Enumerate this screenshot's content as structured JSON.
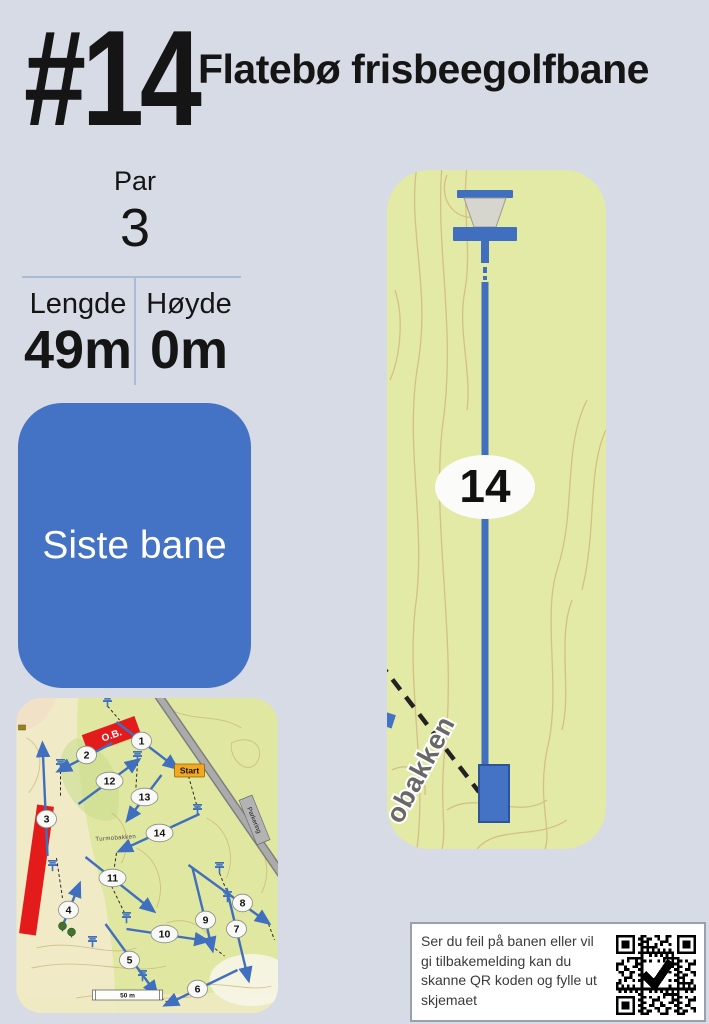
{
  "header": {
    "hole_number": "#14",
    "course_title": "Flatebø frisbeegolfbane"
  },
  "stats": {
    "par_label": "Par",
    "par_value": "3",
    "length_label": "Lengde",
    "length_value": "49m",
    "height_label": "Høyde",
    "height_value": "0m"
  },
  "status_card": {
    "label": "Siste bane",
    "color": "#4472c4"
  },
  "hole_map": {
    "hole_label": "14",
    "road_label": "obakken",
    "map_bg": "#e3eaa5",
    "line_color": "#3f6fbe",
    "contour_color": "#d2b97f"
  },
  "overview_map": {
    "map_bg": "#dfe7a0",
    "labels": {
      "start": "Start",
      "parking": "Parkering",
      "ob": "O.B.",
      "scale": "50 m",
      "road_small": "Turmobakken"
    },
    "hole_markers": [
      {
        "n": "1",
        "x": 125,
        "y": 43
      },
      {
        "n": "2",
        "x": 70,
        "y": 57
      },
      {
        "n": "3",
        "x": 30,
        "y": 121
      },
      {
        "n": "4",
        "x": 52,
        "y": 212
      },
      {
        "n": "5",
        "x": 113,
        "y": 262
      },
      {
        "n": "6",
        "x": 181,
        "y": 291
      },
      {
        "n": "7",
        "x": 220,
        "y": 231
      },
      {
        "n": "8",
        "x": 226,
        "y": 205
      },
      {
        "n": "9",
        "x": 189,
        "y": 222
      },
      {
        "n": "10",
        "x": 148,
        "y": 236
      },
      {
        "n": "11",
        "x": 96,
        "y": 180
      },
      {
        "n": "12",
        "x": 93,
        "y": 83
      },
      {
        "n": "13",
        "x": 128,
        "y": 99
      },
      {
        "n": "14",
        "x": 143,
        "y": 135
      }
    ],
    "arrows": [
      [
        100,
        24,
        160,
        70
      ],
      [
        96,
        45,
        42,
        73
      ],
      [
        31,
        158,
        26,
        46
      ],
      [
        46,
        228,
        63,
        186
      ],
      [
        89,
        226,
        140,
        296
      ],
      [
        221,
        272,
        149,
        307
      ],
      [
        210,
        190,
        232,
        282
      ],
      [
        172,
        167,
        252,
        225
      ],
      [
        176,
        170,
        196,
        252
      ],
      [
        110,
        231,
        191,
        243
      ],
      [
        69,
        159,
        137,
        213
      ],
      [
        62,
        106,
        122,
        62
      ],
      [
        145,
        77,
        111,
        122
      ],
      [
        183,
        116,
        103,
        153
      ]
    ],
    "baskets": [
      [
        91,
        4
      ],
      [
        44,
        67
      ],
      [
        121,
        59
      ],
      [
        181,
        112
      ],
      [
        36,
        168
      ],
      [
        110,
        220
      ],
      [
        126,
        278
      ],
      [
        203,
        170
      ],
      [
        211,
        199
      ],
      [
        76,
        244
      ]
    ],
    "dashes": [
      [
        91,
        8,
        103,
        22
      ],
      [
        150,
        64,
        170,
        70
      ],
      [
        44,
        73,
        44,
        98
      ],
      [
        121,
        65,
        119,
        96
      ],
      [
        172,
        78,
        181,
        110
      ],
      [
        40,
        160,
        46,
        200
      ],
      [
        100,
        155,
        95,
        188
      ],
      [
        95,
        188,
        109,
        217
      ],
      [
        190,
        244,
        208,
        258
      ],
      [
        252,
        226,
        258,
        242
      ],
      [
        140,
        297,
        152,
        305
      ],
      [
        203,
        175,
        211,
        195
      ]
    ]
  },
  "feedback": {
    "text": "Ser du feil på banen eller vil gi tilbakemelding kan du skanne QR koden og fylle ut skjemaet"
  }
}
